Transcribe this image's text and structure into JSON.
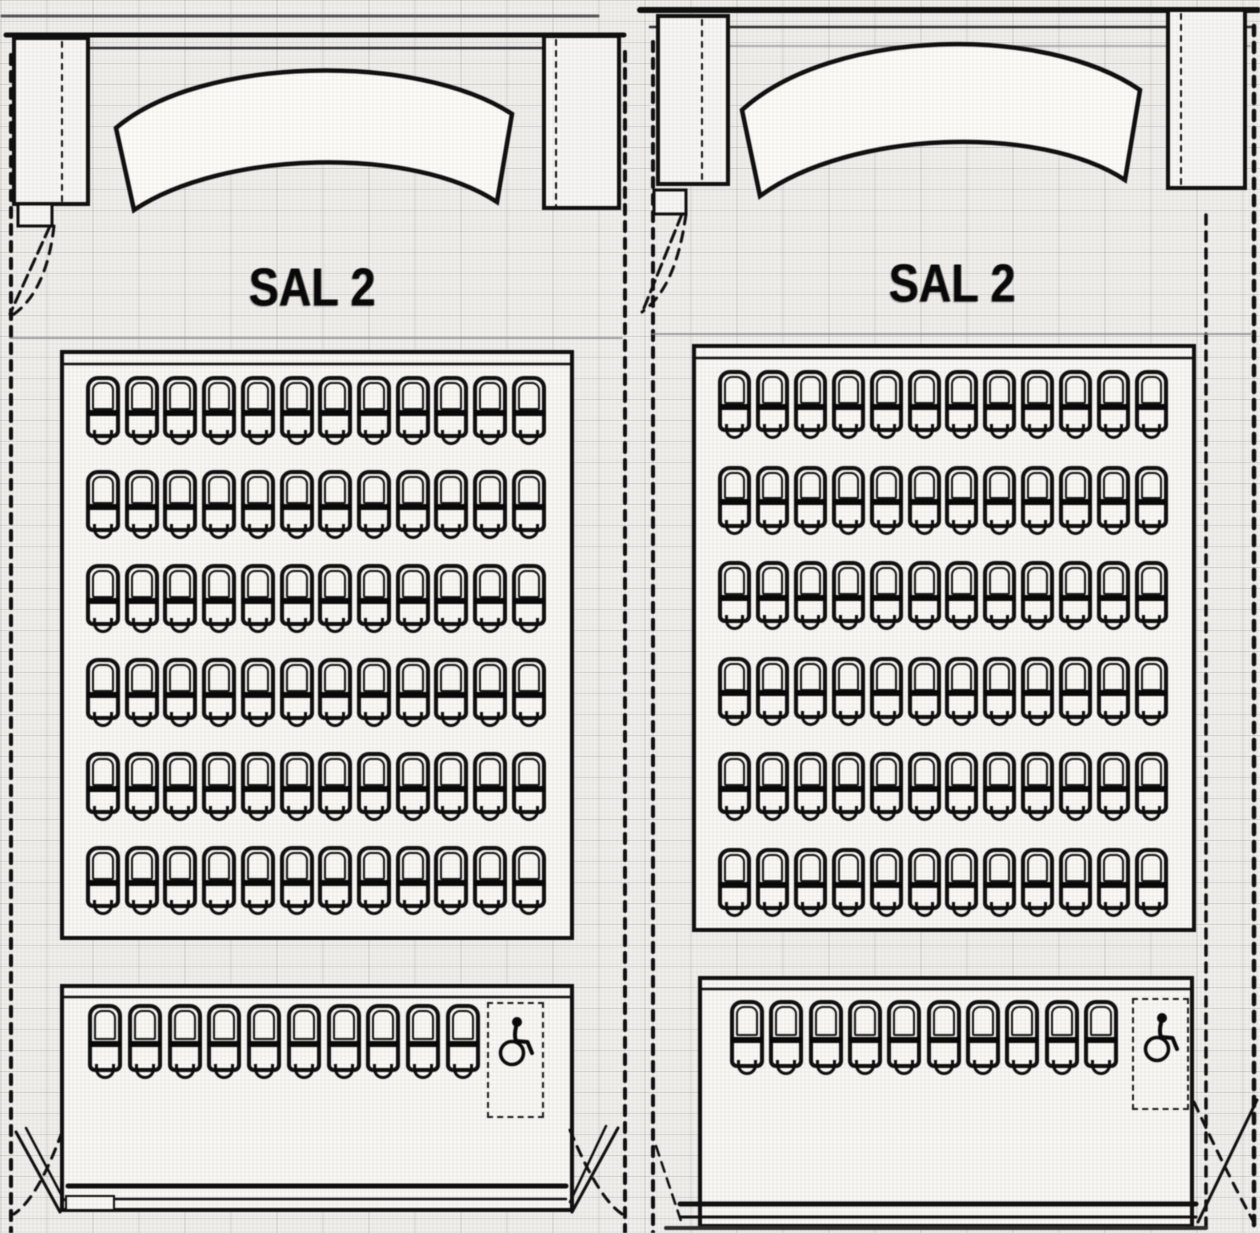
{
  "document": {
    "kind": "scanned cinema seating floor plan, shown twice side by side",
    "colors": {
      "paper": "#f1f0ed",
      "ink": "#161616",
      "block_fill": "#f2f1ee",
      "screen_fill": "#f6f5f2"
    }
  },
  "panels": [
    {
      "name": "left-plan",
      "hall_label": "SAL 2",
      "has_screen": true,
      "main_rows_seats": [
        12,
        12,
        12,
        12,
        12,
        12
      ],
      "front_row_seats": 10,
      "wheelchair_space": true
    },
    {
      "name": "right-plan",
      "hall_label": "SAL 2",
      "has_screen": true,
      "main_rows_seats": [
        12,
        12,
        12,
        12,
        12,
        12
      ],
      "front_row_seats": 10,
      "wheelchair_space": true
    }
  ]
}
